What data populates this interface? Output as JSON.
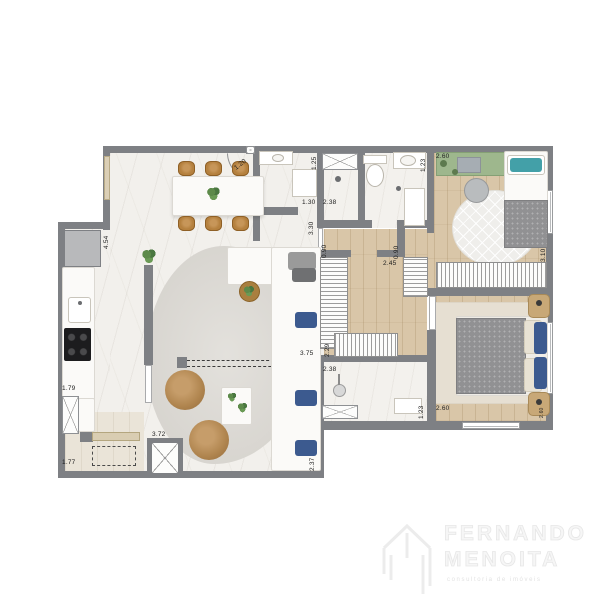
{
  "document": {
    "type": "apartment floor plan render",
    "background": "#ffffff"
  },
  "palette": {
    "wall": "#7e8084",
    "wood_floor": "#d9c6a8",
    "marble_floor": "#f2f0ec",
    "laundry_floor": "#eae4d8",
    "desk_green": "#9eb78d",
    "teal_pillow": "#43a0a8",
    "blue_pillow": "#3c5a8f",
    "stool_brown": "#b5813f",
    "armchair_brown": "#ab8050",
    "blanket_gray": "#919193",
    "dimension_text": "#1d1d1d",
    "logo_gray": "#ededed"
  },
  "dimensions": {
    "entry_door": "1.20",
    "hall_width": "1.25",
    "hall_depth": "1.30",
    "hall_corridor": "3.30",
    "bath1_width": "2.38",
    "bath2_width": "1.23",
    "desk_width": "2.60",
    "kitchen_length": "4.54",
    "corridor_door_left": "0.90",
    "corridor_door_right": "0.90",
    "corridor_length": "2.45",
    "bedroom1_depth": "3.10",
    "closet_depth": "2.29",
    "living_width": "3.75",
    "ensuite_width": "2.38",
    "ensuite_depth": "1.23",
    "master_width": "2.60",
    "master_side": "2.60",
    "kitchen_cabinet": "1.79",
    "living_length": "3.72",
    "laundry_width": "1.77",
    "terrace_depth": "2.37"
  },
  "logo": {
    "name_line1": "FERNANDO",
    "name_line2": "MENOITA",
    "tagline": "consultoria de imóveis"
  }
}
